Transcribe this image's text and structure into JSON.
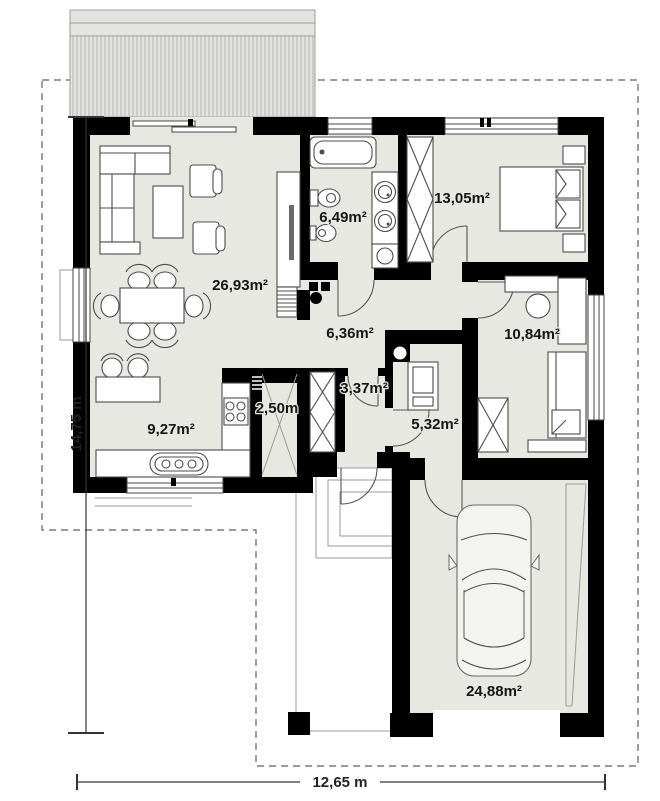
{
  "plan": {
    "rooms": [
      {
        "id": "living-dining",
        "label": "26,93m²"
      },
      {
        "id": "bathroom",
        "label": "6,49m²"
      },
      {
        "id": "bedroom-1",
        "label": "13,05m²"
      },
      {
        "id": "hall",
        "label": "6,36m²"
      },
      {
        "id": "bedroom-2",
        "label": "10,84m²"
      },
      {
        "id": "wc",
        "label": "3,37m²"
      },
      {
        "id": "utility",
        "label": "5,32m²"
      },
      {
        "id": "kitchen",
        "label": "9,27m²"
      },
      {
        "id": "pantry",
        "label": "2,50m"
      },
      {
        "id": "garage",
        "label": "24,88m²"
      }
    ],
    "dimensions": {
      "left": "14,75 m",
      "bottom": "12,65 m"
    },
    "colors": {
      "wall": "#000000",
      "floor": "#e8e8e2",
      "roof_fill": "#e3e3e1",
      "roof_hatch": "#b5b5b3",
      "boundary_dash": "#7a7a7a",
      "furniture_line": "#4c4c4c"
    }
  }
}
